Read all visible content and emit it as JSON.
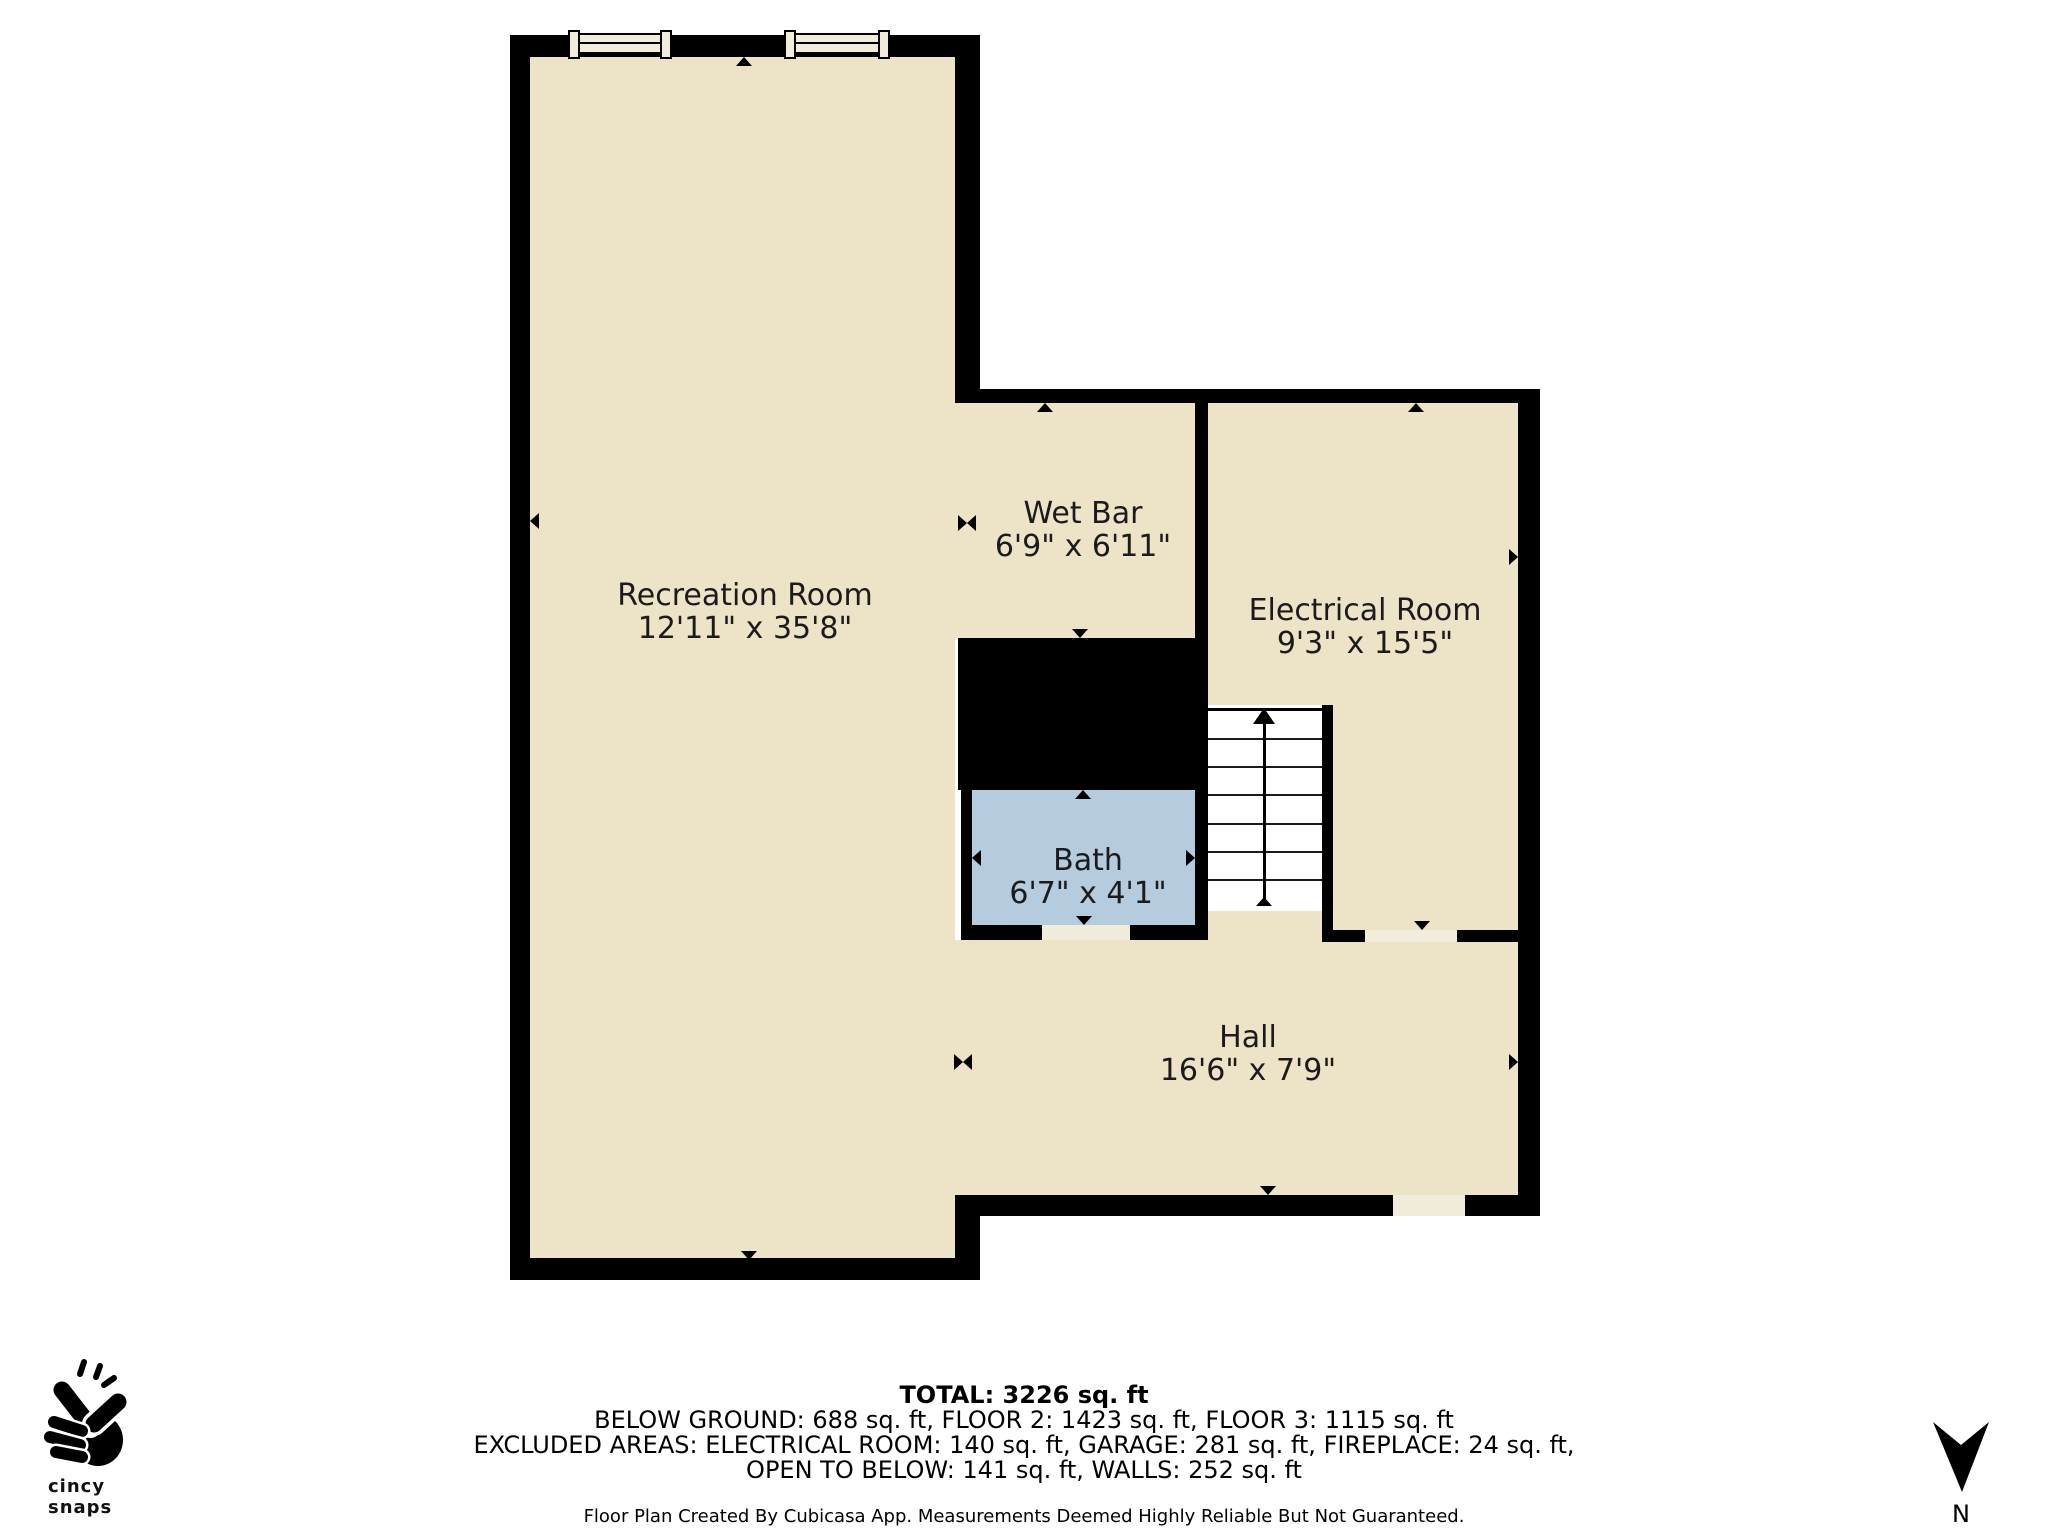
{
  "colors": {
    "wall": "#000000",
    "floor": "#EDE3C7",
    "bath_floor": "#B4CCDE",
    "sill": "#F2ECDA",
    "background": "#FFFFFF",
    "label_text": "#1B1B1B"
  },
  "rooms": {
    "recreation": {
      "name": "Recreation Room",
      "dims": "12'11\" x 35'8\""
    },
    "wet_bar": {
      "name": "Wet Bar",
      "dims": "6'9\" x 6'11\""
    },
    "electrical": {
      "name": "Electrical Room",
      "dims": "9'3\" x 15'5\""
    },
    "bath": {
      "name": "Bath",
      "dims": "6'7\" x 4'1\""
    },
    "hall": {
      "name": "Hall",
      "dims": "16'6\" x 7'9\""
    }
  },
  "summary": {
    "total": "TOTAL: 3226 sq. ft",
    "floors": "BELOW GROUND: 688 sq. ft, FLOOR 2: 1423 sq. ft, FLOOR 3: 1115 sq. ft",
    "excluded": "EXCLUDED AREAS: ELECTRICAL ROOM: 140 sq. ft, GARAGE: 281 sq. ft, FIREPLACE: 24 sq. ft,",
    "excluded2": "OPEN TO BELOW: 141 sq. ft, WALLS: 252 sq. ft",
    "disclaimer": "Floor Plan Created By Cubicasa App. Measurements Deemed Highly Reliable But Not Guaranteed."
  },
  "branding": {
    "logo_text": "cincy snaps"
  },
  "compass": {
    "north_label": "N"
  }
}
